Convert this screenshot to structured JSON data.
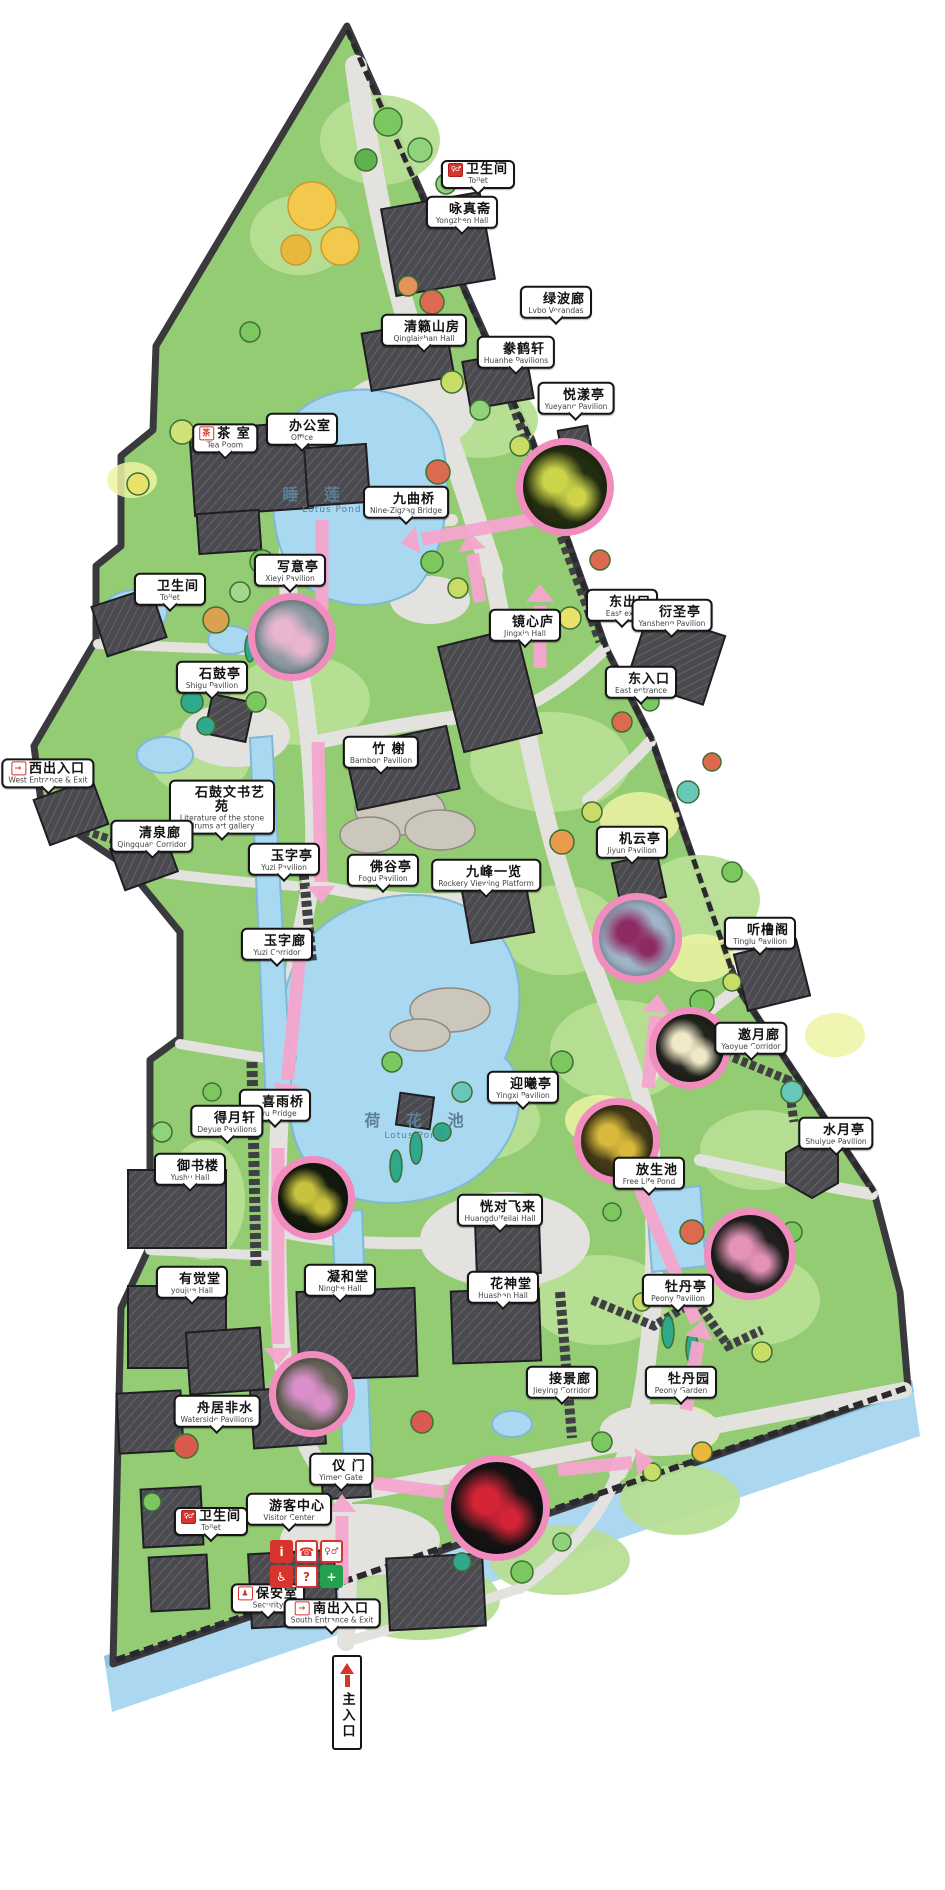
{
  "colors": {
    "route_pink": "#F5A6CE",
    "ring_pink": "#F18CBE",
    "water": "#A9D9F1",
    "park_green": "#94CC74",
    "path_gray": "#E3E2DE",
    "wall_dark": "#3A3A3E",
    "label_border": "#151515",
    "icon_red": "#D6342C",
    "aid_green": "#23A24D",
    "pond_text": "#5D7F95"
  },
  "icons": {
    "toilet": "♀♂",
    "tea": "茶",
    "exit": "→",
    "security": "♟"
  },
  "ponds": [
    {
      "zh": "睡 莲 池",
      "en": "Lotus Pond",
      "x": 332,
      "y": 498
    },
    {
      "zh": "荷 花 池",
      "en": "Lotus Pond",
      "x": 414,
      "y": 1124
    }
  ],
  "labels": [
    {
      "zh": "卫生间",
      "en": "Toilet",
      "x": 478,
      "y": 176,
      "icon": "toilet"
    },
    {
      "zh": "咏真斋",
      "en": "Yongzhen Hall",
      "x": 462,
      "y": 214
    },
    {
      "zh": "绿波廊",
      "en": "Lvbo Verandas",
      "x": 556,
      "y": 304
    },
    {
      "zh": "清籁山房",
      "en": "Qinglaishan Hall",
      "x": 424,
      "y": 332
    },
    {
      "zh": "豢鹤轩",
      "en": "Huanhe Pavilions",
      "x": 516,
      "y": 354
    },
    {
      "zh": "悦漾亭",
      "en": "Yueyang Pavilion",
      "x": 576,
      "y": 400
    },
    {
      "zh": "茶 室",
      "en": "Tea Room",
      "x": 225,
      "y": 440,
      "icon": "tea"
    },
    {
      "zh": "办公室",
      "en": "Office",
      "x": 302,
      "y": 431
    },
    {
      "zh": "九曲桥",
      "en": "Nine-Zigzag Bridge",
      "x": 406,
      "y": 504
    },
    {
      "zh": "写意亭",
      "en": "Xieyi Pavilion",
      "x": 290,
      "y": 572
    },
    {
      "zh": "卫生间",
      "en": "Toilet",
      "x": 170,
      "y": 591
    },
    {
      "zh": "石鼓亭",
      "en": "Shigu Pavilion",
      "x": 212,
      "y": 679
    },
    {
      "zh": "西出入口",
      "en": "West Entrance & Exit",
      "x": 48,
      "y": 775,
      "icon": "exit"
    },
    {
      "zh": "石鼓文书艺苑",
      "en": "Literature of the stone drums art gallery",
      "x": 222,
      "y": 810,
      "wide": true
    },
    {
      "zh": "清泉廊",
      "en": "Qingquan Corridor",
      "x": 152,
      "y": 838
    },
    {
      "zh": "玉字亭",
      "en": "Yuzi Pavilion",
      "x": 284,
      "y": 861
    },
    {
      "zh": "竹 榭",
      "en": "Bamboo Pavilion",
      "x": 381,
      "y": 754
    },
    {
      "zh": "佛谷亭",
      "en": "Fogu Pavilion",
      "x": 383,
      "y": 872
    },
    {
      "zh": "九峰一览",
      "en": "Rockery Viewing Platform",
      "x": 486,
      "y": 877
    },
    {
      "zh": "镜心庐",
      "en": "Jingxin Hall",
      "x": 525,
      "y": 627
    },
    {
      "zh": "东出口",
      "en": "East exit",
      "x": 622,
      "y": 607
    },
    {
      "zh": "衍圣亭",
      "en": "Yansheng Pavilion",
      "x": 672,
      "y": 617
    },
    {
      "zh": "东入口",
      "en": "East entrance",
      "x": 641,
      "y": 684
    },
    {
      "zh": "机云亭",
      "en": "Jiyun Pavilion",
      "x": 632,
      "y": 844
    },
    {
      "zh": "听橹阁",
      "en": "Tinglu Pavilion",
      "x": 760,
      "y": 935
    },
    {
      "zh": "玉字廊",
      "en": "Yuzi Corridor",
      "x": 277,
      "y": 946
    },
    {
      "zh": "邀月廊",
      "en": "Yaoyue Corridor",
      "x": 751,
      "y": 1040
    },
    {
      "zh": "水月亭",
      "en": "Shuiyue Pavilion",
      "x": 836,
      "y": 1135
    },
    {
      "zh": "迎曦亭",
      "en": "Yingxi Pavilion",
      "x": 523,
      "y": 1089
    },
    {
      "zh": "放生池",
      "en": "Free Life Pond",
      "x": 649,
      "y": 1175
    },
    {
      "zh": "喜雨桥",
      "en": "Xiyu Bridge",
      "x": 275,
      "y": 1107
    },
    {
      "zh": "得月轩",
      "en": "Deyue Pavilions",
      "x": 227,
      "y": 1123
    },
    {
      "zh": "御书楼",
      "en": "Yushu Hall",
      "x": 190,
      "y": 1171
    },
    {
      "zh": "恍对飞来",
      "en": "Huangduifeilai Hall",
      "x": 500,
      "y": 1212
    },
    {
      "zh": "有觉堂",
      "en": "youjue Hall",
      "x": 192,
      "y": 1284
    },
    {
      "zh": "凝和堂",
      "en": "Ninghe Hall",
      "x": 340,
      "y": 1282
    },
    {
      "zh": "花神堂",
      "en": "Huashen Hall",
      "x": 503,
      "y": 1289
    },
    {
      "zh": "牡丹亭",
      "en": "Peony Pavilion",
      "x": 678,
      "y": 1292
    },
    {
      "zh": "接景廊",
      "en": "Jieying Corridor",
      "x": 562,
      "y": 1384
    },
    {
      "zh": "牡丹园",
      "en": "Peony Garden",
      "x": 681,
      "y": 1384
    },
    {
      "zh": "舟居非水",
      "en": "Waterside Pavilions",
      "x": 217,
      "y": 1413
    },
    {
      "zh": "仪 门",
      "en": "Yimen Gate",
      "x": 341,
      "y": 1471
    },
    {
      "zh": "游客中心",
      "en": "Visitor Center",
      "x": 289,
      "y": 1511
    },
    {
      "zh": "卫生间",
      "en": "Toilet",
      "x": 211,
      "y": 1523,
      "icon": "toilet"
    },
    {
      "zh": "保安室",
      "en": "Security",
      "x": 268,
      "y": 1600,
      "icon": "security"
    },
    {
      "zh": "南出入口",
      "en": "South Entrance & Exit",
      "x": 332,
      "y": 1615,
      "icon": "exit"
    }
  ],
  "main_entrance": {
    "zh": "主入口",
    "x": 347,
    "y": 1655
  },
  "visitor_panel": {
    "x": 270,
    "y": 1540,
    "icons": [
      {
        "glyph": "i",
        "bg": "#D6342C",
        "fg": "#FFFFFF"
      },
      {
        "glyph": "☎",
        "bg": "#FFFFFF",
        "fg": "#D6342C"
      },
      {
        "glyph": "♀♂",
        "bg": "#FFFFFF",
        "fg": "#D6342C"
      },
      {
        "glyph": "♿",
        "bg": "#D6342C",
        "fg": "#FFFFFF"
      },
      {
        "glyph": "?",
        "bg": "#FFFFFF",
        "fg": "#D6342C"
      },
      {
        "glyph": "+",
        "bg": "#23A24D",
        "fg": "#FFFFFF"
      }
    ]
  },
  "photo_spots": [
    {
      "x": 565,
      "y": 487,
      "r": 42,
      "bg": "#232D10",
      "accent": "#CDD44A"
    },
    {
      "x": 292,
      "y": 637,
      "r": 37,
      "bg": "#8E9AA4",
      "accent": "#EAB6CF"
    },
    {
      "x": 637,
      "y": 938,
      "r": 38,
      "bg": "#9FB6C9",
      "accent": "#8E2A62"
    },
    {
      "x": 690,
      "y": 1048,
      "r": 34,
      "bg": "#23231D",
      "accent": "#EFE9C8"
    },
    {
      "x": 617,
      "y": 1141,
      "r": 36,
      "bg": "#433A17",
      "accent": "#D9B93C"
    },
    {
      "x": 750,
      "y": 1254,
      "r": 39,
      "bg": "#20201E",
      "accent": "#E592B8"
    },
    {
      "x": 313,
      "y": 1198,
      "r": 35,
      "bg": "#141A0D",
      "accent": "#C8C23E"
    },
    {
      "x": 312,
      "y": 1394,
      "r": 36,
      "bg": "#6A665C",
      "accent": "#DA8FCB"
    },
    {
      "x": 497,
      "y": 1508,
      "r": 46,
      "bg": "#151313",
      "accent": "#D42436"
    }
  ],
  "route_arrows": [
    {
      "x1": 540,
      "y1": 518,
      "x2": 418,
      "y2": 540
    },
    {
      "x1": 480,
      "y1": 602,
      "x2": 472,
      "y2": 550
    },
    {
      "x1": 540,
      "y1": 668,
      "x2": 540,
      "y2": 602
    },
    {
      "x1": 322,
      "y1": 520,
      "x2": 322,
      "y2": 648
    },
    {
      "x1": 318,
      "y1": 742,
      "x2": 321,
      "y2": 886
    },
    {
      "x1": 300,
      "y1": 952,
      "x2": 287,
      "y2": 1084
    },
    {
      "x1": 278,
      "y1": 1148,
      "x2": 278,
      "y2": 1348
    },
    {
      "x1": 342,
      "y1": 1584,
      "x2": 342,
      "y2": 1512
    },
    {
      "x1": 374,
      "y1": 1483,
      "x2": 448,
      "y2": 1493
    },
    {
      "x1": 558,
      "y1": 1470,
      "x2": 636,
      "y2": 1462
    },
    {
      "x1": 686,
      "y1": 1410,
      "x2": 699,
      "y2": 1338
    },
    {
      "x1": 696,
      "y1": 1322,
      "x2": 633,
      "y2": 1172
    },
    {
      "x1": 648,
      "y1": 1088,
      "x2": 656,
      "y2": 1012
    }
  ]
}
